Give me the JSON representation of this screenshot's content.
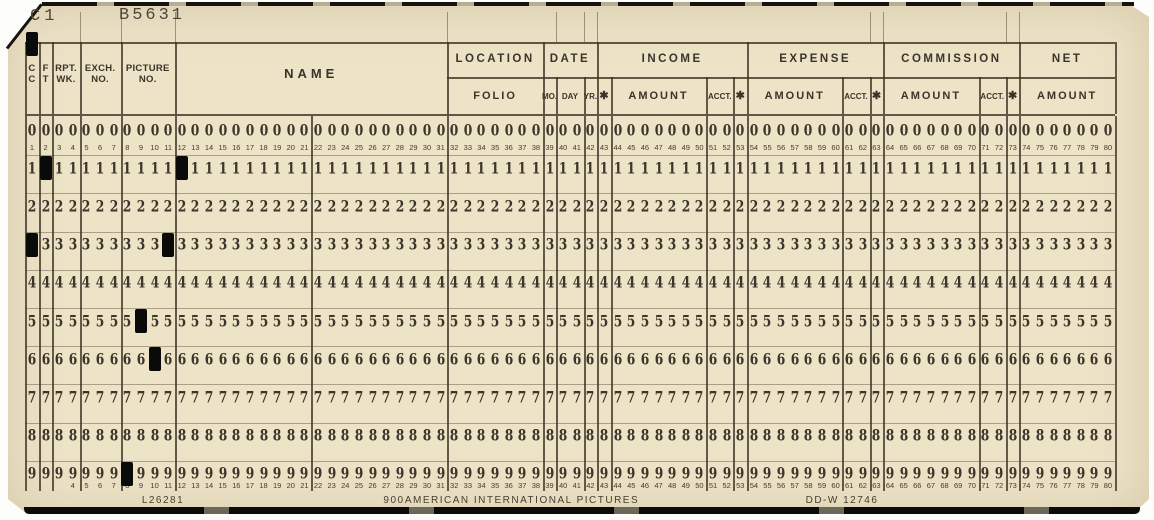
{
  "stamps": {
    "interpretation": "C1",
    "serial": "B5631"
  },
  "header": {
    "single_fields": [
      {
        "lines": [
          "C",
          "C"
        ],
        "cols": [
          1,
          1
        ]
      },
      {
        "lines": [
          "F",
          "T"
        ],
        "cols": [
          2,
          2
        ]
      },
      {
        "lines": [
          "RPT.",
          "WK."
        ],
        "cols": [
          3,
          4
        ]
      },
      {
        "lines": [
          "EXCH.",
          "NO."
        ],
        "cols": [
          5,
          7
        ]
      },
      {
        "lines": [
          "PICTURE",
          "NO."
        ],
        "cols": [
          8,
          11
        ]
      },
      {
        "lines": [
          "NAME"
        ],
        "cols": [
          12,
          31
        ],
        "wide": true
      }
    ],
    "sections": [
      {
        "label": "LOCATION",
        "cols": [
          32,
          38
        ]
      },
      {
        "label": "DATE",
        "cols": [
          39,
          42
        ]
      },
      {
        "label": "INCOME",
        "cols": [
          43,
          53
        ]
      },
      {
        "label": "EXPENSE",
        "cols": [
          54,
          63
        ]
      },
      {
        "label": "COMMISSION",
        "cols": [
          64,
          73
        ]
      },
      {
        "label": "NET",
        "cols": [
          74,
          80
        ]
      }
    ],
    "subfields": [
      {
        "label": "FOLIO",
        "cols": [
          32,
          38
        ]
      },
      {
        "label": "MO.",
        "cols": [
          39,
          39
        ],
        "small": true
      },
      {
        "label": "DAY",
        "cols": [
          40,
          41
        ],
        "small": true
      },
      {
        "label": "YR.",
        "cols": [
          42,
          42
        ],
        "small": true
      },
      {
        "label": "✱",
        "cols": [
          43,
          43
        ],
        "star": true
      },
      {
        "label": "AMOUNT",
        "cols": [
          44,
          50
        ]
      },
      {
        "label": "ACCT.",
        "cols": [
          51,
          52
        ],
        "small": true
      },
      {
        "label": "✱",
        "cols": [
          53,
          53
        ],
        "star": true
      },
      {
        "label": "AMOUNT",
        "cols": [
          54,
          60
        ]
      },
      {
        "label": "ACCT.",
        "cols": [
          61,
          62
        ],
        "small": true
      },
      {
        "label": "✱",
        "cols": [
          63,
          63
        ],
        "star": true
      },
      {
        "label": "AMOUNT",
        "cols": [
          64,
          70
        ]
      },
      {
        "label": "ACCT.",
        "cols": [
          71,
          72
        ],
        "small": true
      },
      {
        "label": "✱",
        "cols": [
          73,
          73
        ],
        "star": true
      },
      {
        "label": "AMOUNT",
        "cols": [
          74,
          80
        ]
      }
    ]
  },
  "grid": {
    "digits": [
      "0",
      "1",
      "2",
      "3",
      "4",
      "5",
      "6",
      "7",
      "8",
      "9"
    ],
    "columns": 80,
    "top_numbers_from": 1,
    "bottom_numbers_from": 4,
    "separators_after_cols": [
      1,
      2,
      4,
      7,
      11,
      21,
      31,
      38,
      39,
      41,
      42,
      43,
      50,
      52,
      53,
      60,
      62,
      63,
      70,
      72,
      73,
      80
    ]
  },
  "punches": [
    {
      "col": 1,
      "zone": "12"
    },
    {
      "col": 1,
      "row": 3
    },
    {
      "col": 2,
      "row": 1
    },
    {
      "col": 8,
      "row": 9
    },
    {
      "col": 9,
      "row": 5
    },
    {
      "col": 10,
      "row": 6
    },
    {
      "col": 11,
      "row": 3
    },
    {
      "col": 12,
      "row": 1
    }
  ],
  "bottom_print": {
    "left": "L26281",
    "center_left": "900",
    "company": "AMERICAN INTERNATIONAL PICTURES",
    "right": "DD-W 12746"
  },
  "colors": {
    "card_stock": "#ede3c7",
    "ink": "#3c332a",
    "hole": "#0a0a0a"
  }
}
